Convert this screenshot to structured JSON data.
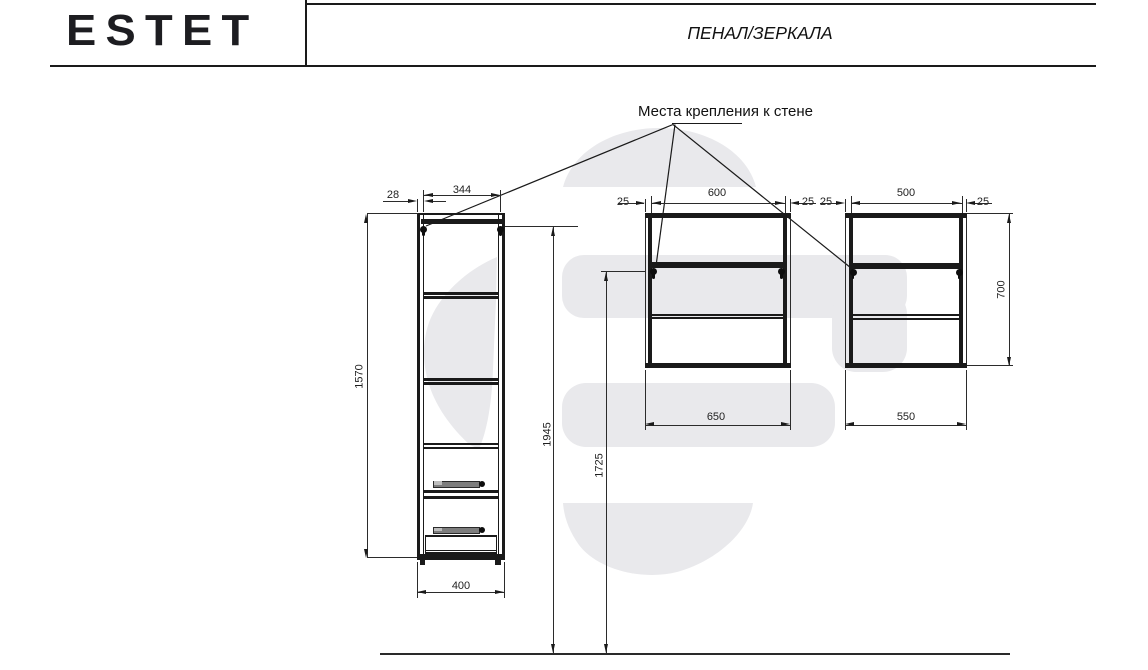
{
  "header": {
    "brand": "ESTET",
    "doc_title": "ПЕНАЛ/ЗЕРКАЛА"
  },
  "annotation": {
    "wall_mount_label": "Места крепления к стене"
  },
  "colors": {
    "line": "#1a1a1a",
    "watermark": "#e9e9ec",
    "handle_gray": "#7d7d7d"
  },
  "tall_cabinet": {
    "top_offset": "28",
    "top_inner_width": "344",
    "height": "1570",
    "width": "400"
  },
  "mirror_cabinet_wide": {
    "body_width": "600",
    "left_overhang": "25",
    "right_overhang": "25",
    "overall_width": "650"
  },
  "mirror_cabinet_narrow": {
    "body_width": "500",
    "left_overhang": "25",
    "right_overhang": "25",
    "overall_width": "550",
    "height": "700"
  },
  "installation": {
    "overall_height": "1945",
    "mount_height": "1725"
  }
}
